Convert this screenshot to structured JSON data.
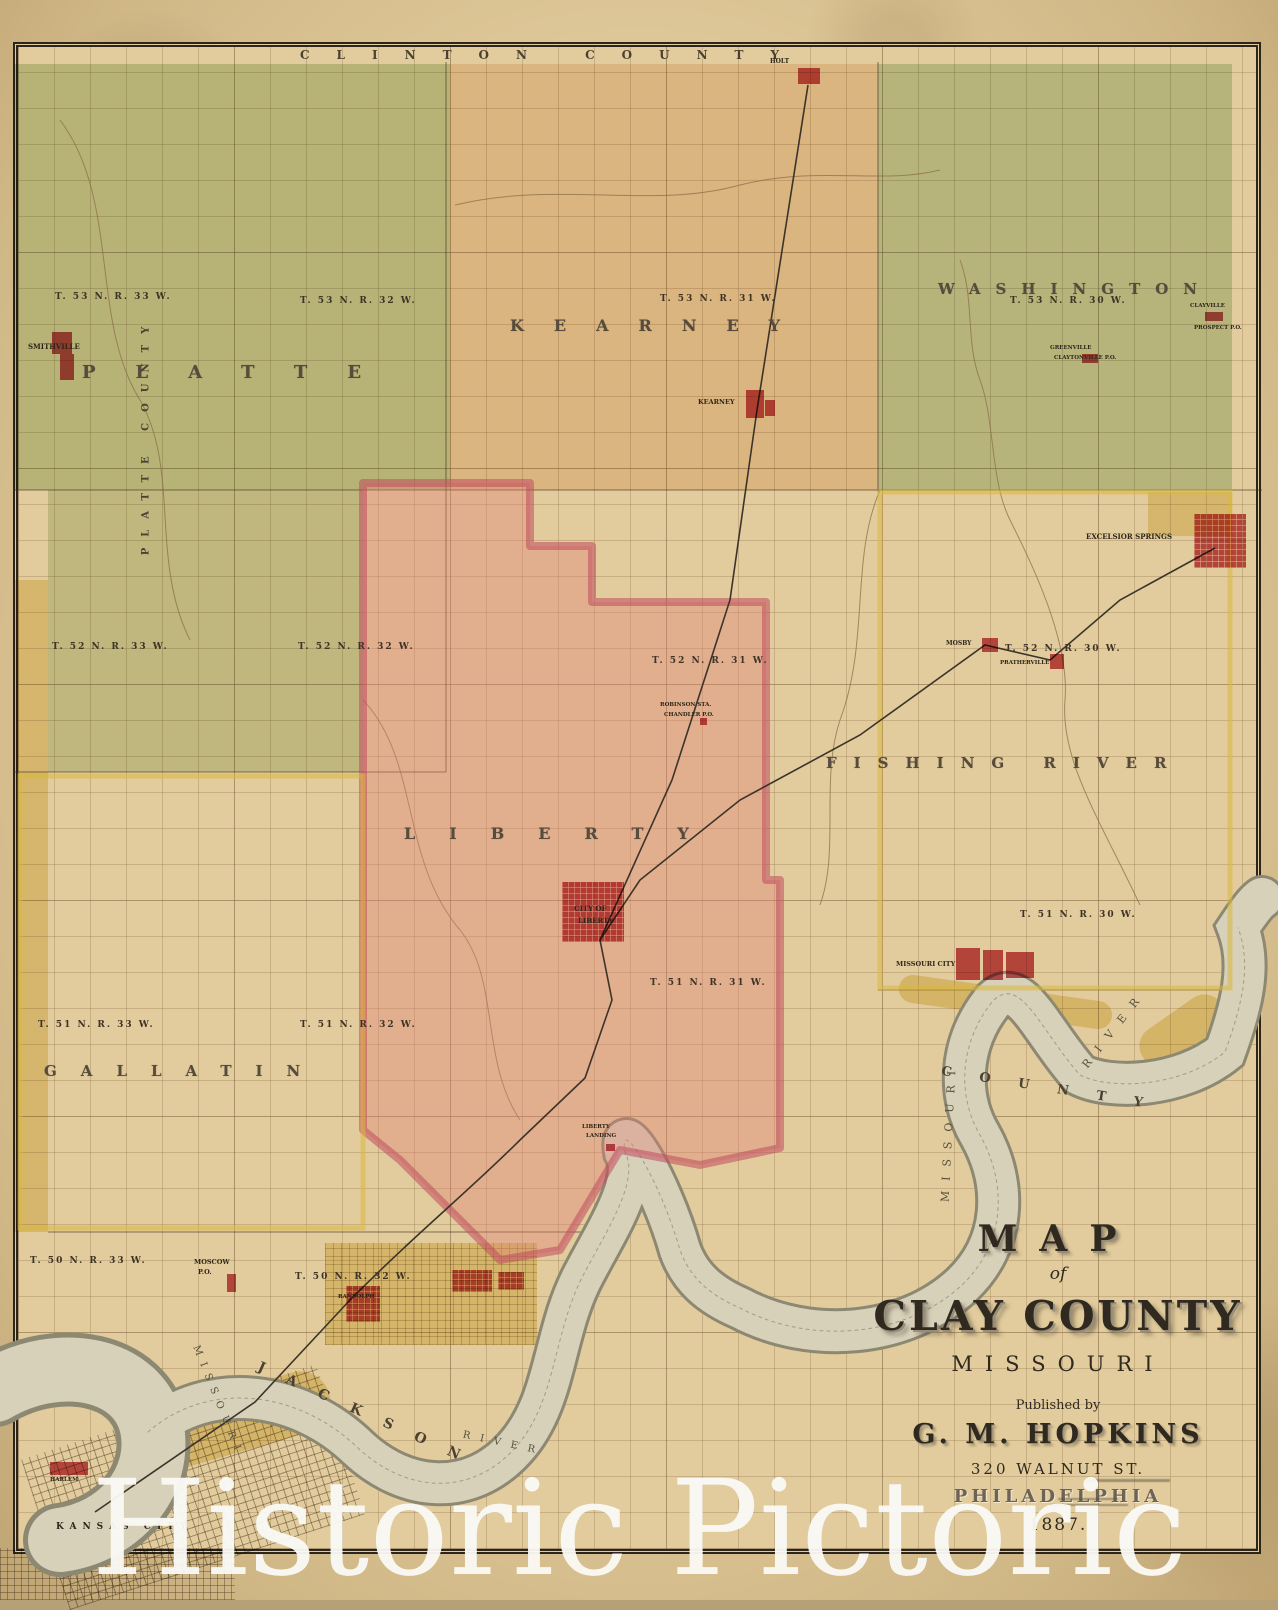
{
  "watermark": "Historic Pictoric",
  "edge_labels": [
    {
      "name": "clinton-county-label",
      "t": "CLINTON  COUNTY",
      "x": 300,
      "y": 48,
      "fs": 12,
      "ls": 27,
      "rot": 0
    },
    {
      "name": "ray-county-label",
      "t": "RAY  COUNTY",
      "x": 1246,
      "y": 400,
      "fs": 11,
      "ls": 16,
      "rot": -90
    },
    {
      "name": "platte-county-label",
      "t": "PLATTE  COUNTY",
      "x": 26,
      "y": 430,
      "fs": 10,
      "ls": 11,
      "rot": -90
    },
    {
      "name": "jackson-county-label",
      "t": "JACKSON",
      "x": 248,
      "y": 1408,
      "fs": 14,
      "ls": 24,
      "rot": 24
    },
    {
      "name": "county-bottom-label",
      "t": "COUNTY",
      "x": 940,
      "y": 1082,
      "fs": 13,
      "ls": 28,
      "rot": 9
    }
  ],
  "townships": [
    {
      "name": "township-platte",
      "t": "PLATTE",
      "x": 82,
      "y": 362,
      "fs": 18,
      "ls": 40
    },
    {
      "name": "township-kearney",
      "t": "KEARNEY",
      "x": 510,
      "y": 316,
      "fs": 16,
      "ls": 30
    },
    {
      "name": "township-washington",
      "t": "WASHINGTON",
      "x": 938,
      "y": 280,
      "fs": 15,
      "ls": 15
    },
    {
      "name": "township-liberty",
      "t": "LIBERTY",
      "x": 404,
      "y": 824,
      "fs": 16,
      "ls": 34
    },
    {
      "name": "township-fishing-river",
      "t": "FISHING  RIVER",
      "x": 826,
      "y": 754,
      "fs": 15,
      "ls": 17
    },
    {
      "name": "township-gallatin",
      "t": "GALLATIN",
      "x": 44,
      "y": 1062,
      "fs": 15,
      "ls": 24
    }
  ],
  "range_labels": [
    {
      "name": "range-t53-r33",
      "t": "T. 53 N.  R. 33 W.",
      "x": 55,
      "y": 292,
      "fs": 9,
      "ls": 2
    },
    {
      "name": "range-t53-r32",
      "t": "T. 53 N.  R. 32 W.",
      "x": 300,
      "y": 296,
      "fs": 9,
      "ls": 2
    },
    {
      "name": "range-t53-r31",
      "t": "T. 53 N.  R. 31 W.",
      "x": 660,
      "y": 294,
      "fs": 9,
      "ls": 2
    },
    {
      "name": "range-t53-r30",
      "t": "T. 53 N.  R. 30 W.",
      "x": 1010,
      "y": 296,
      "fs": 9,
      "ls": 2
    },
    {
      "name": "range-t52-r33",
      "t": "T. 52 N.  R. 33 W.",
      "x": 52,
      "y": 642,
      "fs": 9,
      "ls": 2
    },
    {
      "name": "range-t52-r32",
      "t": "T. 52 N.  R. 32 W.",
      "x": 298,
      "y": 642,
      "fs": 9,
      "ls": 2
    },
    {
      "name": "range-t52-r31",
      "t": "T. 52 N.  R. 31 W.",
      "x": 652,
      "y": 656,
      "fs": 9,
      "ls": 2
    },
    {
      "name": "range-t52-r30",
      "t": "T. 52 N.  R. 30 W.",
      "x": 1005,
      "y": 644,
      "fs": 9,
      "ls": 2
    },
    {
      "name": "range-t51-r33",
      "t": "T. 51 N.  R. 33 W.",
      "x": 38,
      "y": 1020,
      "fs": 9,
      "ls": 2
    },
    {
      "name": "range-t51-r32",
      "t": "T. 51 N.  R. 32 W.",
      "x": 300,
      "y": 1020,
      "fs": 9,
      "ls": 2
    },
    {
      "name": "range-t51-r31",
      "t": "T. 51 N.  R. 31 W.",
      "x": 650,
      "y": 978,
      "fs": 9,
      "ls": 2
    },
    {
      "name": "range-t51-r30",
      "t": "T. 51 N.  R. 30 W.",
      "x": 1020,
      "y": 910,
      "fs": 9,
      "ls": 2
    },
    {
      "name": "range-t50-r33",
      "t": "T. 50 N.  R. 33 W.",
      "x": 30,
      "y": 1256,
      "fs": 9,
      "ls": 2
    },
    {
      "name": "range-t50-r32",
      "t": "T. 50 N.  R. 32 W.",
      "x": 295,
      "y": 1272,
      "fs": 9,
      "ls": 2
    }
  ],
  "river_words": [
    {
      "name": "missouri-river-label-bend",
      "t": "MISSOURI",
      "x": 878,
      "y": 1125,
      "fs": 11,
      "ls": 10,
      "rot": -87
    },
    {
      "name": "river-label-east",
      "t": "RIVER",
      "x": 1066,
      "y": 1022,
      "fs": 11,
      "ls": 12,
      "rot": -52
    },
    {
      "name": "missouri-river-label-west",
      "t": "MISSOURI",
      "x": 158,
      "y": 1396,
      "fs": 10,
      "ls": 8,
      "rot": 68
    },
    {
      "name": "river-label-west",
      "t": "RIVER",
      "x": 462,
      "y": 1438,
      "fs": 10,
      "ls": 10,
      "rot": 12
    }
  ],
  "towns": [
    {
      "name": "smithville",
      "label": "SMITHVILLE",
      "lx": 28,
      "ly": 342,
      "fs": 7,
      "blocks": [
        [
          52,
          332,
          20,
          22
        ],
        [
          60,
          354,
          14,
          26
        ]
      ]
    },
    {
      "name": "holt",
      "label": "HOLT",
      "lx": 770,
      "ly": 58,
      "fs": 6,
      "blocks": [
        [
          798,
          68,
          22,
          16
        ]
      ]
    },
    {
      "name": "kearney-town",
      "label": "KEARNEY",
      "lx": 698,
      "ly": 398,
      "fs": 6.5,
      "blocks": [
        [
          746,
          390,
          18,
          28
        ],
        [
          765,
          400,
          10,
          16
        ]
      ]
    },
    {
      "name": "excelsior-springs",
      "label": "EXCELSIOR SPRINGS",
      "lx": 1086,
      "ly": 532,
      "fs": 7,
      "grid": true,
      "blocks": [
        [
          1194,
          514,
          52,
          54
        ]
      ]
    },
    {
      "name": "greenville",
      "label": "GREENVILLE",
      "sub": "CLAYTONVILLE P.O.",
      "lx": 1050,
      "ly": 345,
      "sy": 355,
      "fs": 5.5,
      "blocks": [
        [
          1082,
          354,
          16,
          9
        ]
      ]
    },
    {
      "name": "clayville",
      "label": "CLAYVILLE",
      "sub": "PROSPECT P.O.",
      "lx": 1190,
      "ly": 303,
      "sy": 325,
      "fs": 5.5,
      "blocks": [
        [
          1205,
          312,
          18,
          9
        ]
      ]
    },
    {
      "name": "mosby",
      "label": "MOSBY",
      "lx": 946,
      "ly": 640,
      "fs": 6,
      "blocks": [
        [
          982,
          638,
          16,
          14
        ]
      ]
    },
    {
      "name": "prathersville",
      "label": "PRATHERVILLE",
      "lx": 1000,
      "ly": 660,
      "fs": 5.5,
      "blocks": [
        [
          1050,
          654,
          14,
          15
        ]
      ]
    },
    {
      "name": "robinson-sta",
      "label": "ROBINSON STA.",
      "sub": "CHANDLER P.O.",
      "lx": 660,
      "ly": 702,
      "sy": 712,
      "fs": 5.5,
      "blocks": [
        [
          700,
          718,
          7,
          7
        ]
      ]
    },
    {
      "name": "missouri-city",
      "label": "MISSOURI CITY",
      "lx": 896,
      "ly": 960,
      "fs": 6.5,
      "blocks": [
        [
          956,
          948,
          24,
          32
        ],
        [
          983,
          950,
          20,
          30
        ],
        [
          1006,
          952,
          28,
          26
        ]
      ]
    },
    {
      "name": "city-of-liberty",
      "label": "CITY OF",
      "sub": "LIBERTY",
      "lx": 574,
      "ly": 904,
      "sy": 916,
      "fs": 7,
      "grid": true,
      "blocks": [
        [
          562,
          882,
          62,
          60
        ]
      ]
    },
    {
      "name": "liberty-landing",
      "label": "LIBERTY",
      "sub": "LANDING",
      "lx": 582,
      "ly": 1124,
      "sy": 1133,
      "fs": 5.5,
      "blocks": [
        [
          606,
          1144,
          9,
          7
        ]
      ]
    },
    {
      "name": "moscow",
      "label": "MOSCOW",
      "sub": "P.O.",
      "lx": 194,
      "ly": 1258,
      "sy": 1268,
      "fs": 6.5,
      "blocks": [
        [
          227,
          1274,
          9,
          18
        ]
      ]
    },
    {
      "name": "randolph",
      "label": "RANDOLPH",
      "lx": 338,
      "ly": 1294,
      "fs": 5.5,
      "grid": true,
      "blocks": [
        [
          346,
          1286,
          34,
          36
        ],
        [
          452,
          1270,
          40,
          22
        ],
        [
          498,
          1272,
          26,
          18
        ]
      ]
    },
    {
      "name": "harlem",
      "label": "HARLEM",
      "lx": 50,
      "ly": 1477,
      "fs": 5.5,
      "blocks": [
        [
          50,
          1462,
          38,
          13
        ]
      ]
    },
    {
      "name": "kansas-city",
      "label": "KANSAS CITY",
      "lx": 56,
      "ly": 1522,
      "fs": 9,
      "ls": 6,
      "blocks": []
    }
  ],
  "title_block": {
    "line1": "MAP",
    "line2": "of",
    "line3": "CLAY COUNTY",
    "line4": "MISSOURI",
    "line5": "Published by",
    "line6": "G. M. HOPKINS",
    "line7": "320 WALNUT ST.",
    "line8": "PHILADELPHIA",
    "line9": "1887."
  },
  "colors": {
    "paper": "#ddc697",
    "map_base": "#e2cc9d",
    "platte_green": "#c7d7ae",
    "washington_green": "#c3d4b2",
    "kearney_peach": "#e6c295",
    "liberty_pink": "#e0807a",
    "liberty_border": "#c14b5e",
    "river_fill": "#d8d1ba",
    "river_edge": "#8d8872",
    "town_red": "#c23e48",
    "yellow_tint": "#e4c23f",
    "ink": "#3a3123",
    "watermark_white": "#fbfaf6"
  }
}
